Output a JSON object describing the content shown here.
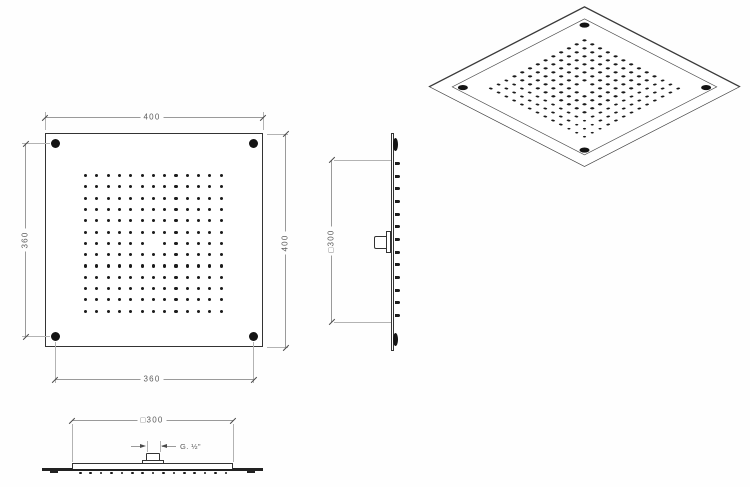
{
  "drawing_title": "square-ceiling-shower-head-technical-drawing",
  "colors": {
    "background": "#fefefe",
    "object_line": "#333333",
    "dimension_line": "#9a9a9a",
    "dimension_text": "#5c5c5c",
    "nozzle_dot": "#1b1b1b"
  },
  "front_view": {
    "dim_top": "400",
    "dim_right": "400",
    "dim_left": "360",
    "dim_bottom": "360",
    "corner_screws": 4
  },
  "side_view": {
    "dim_square": "□300"
  },
  "bottom_view": {
    "dim_square": "□300",
    "thread": "G. ½\"",
    "nozzle_count": 15
  },
  "nozzle_grid": {
    "rows": 13,
    "cols": 13,
    "omit_center": true
  }
}
